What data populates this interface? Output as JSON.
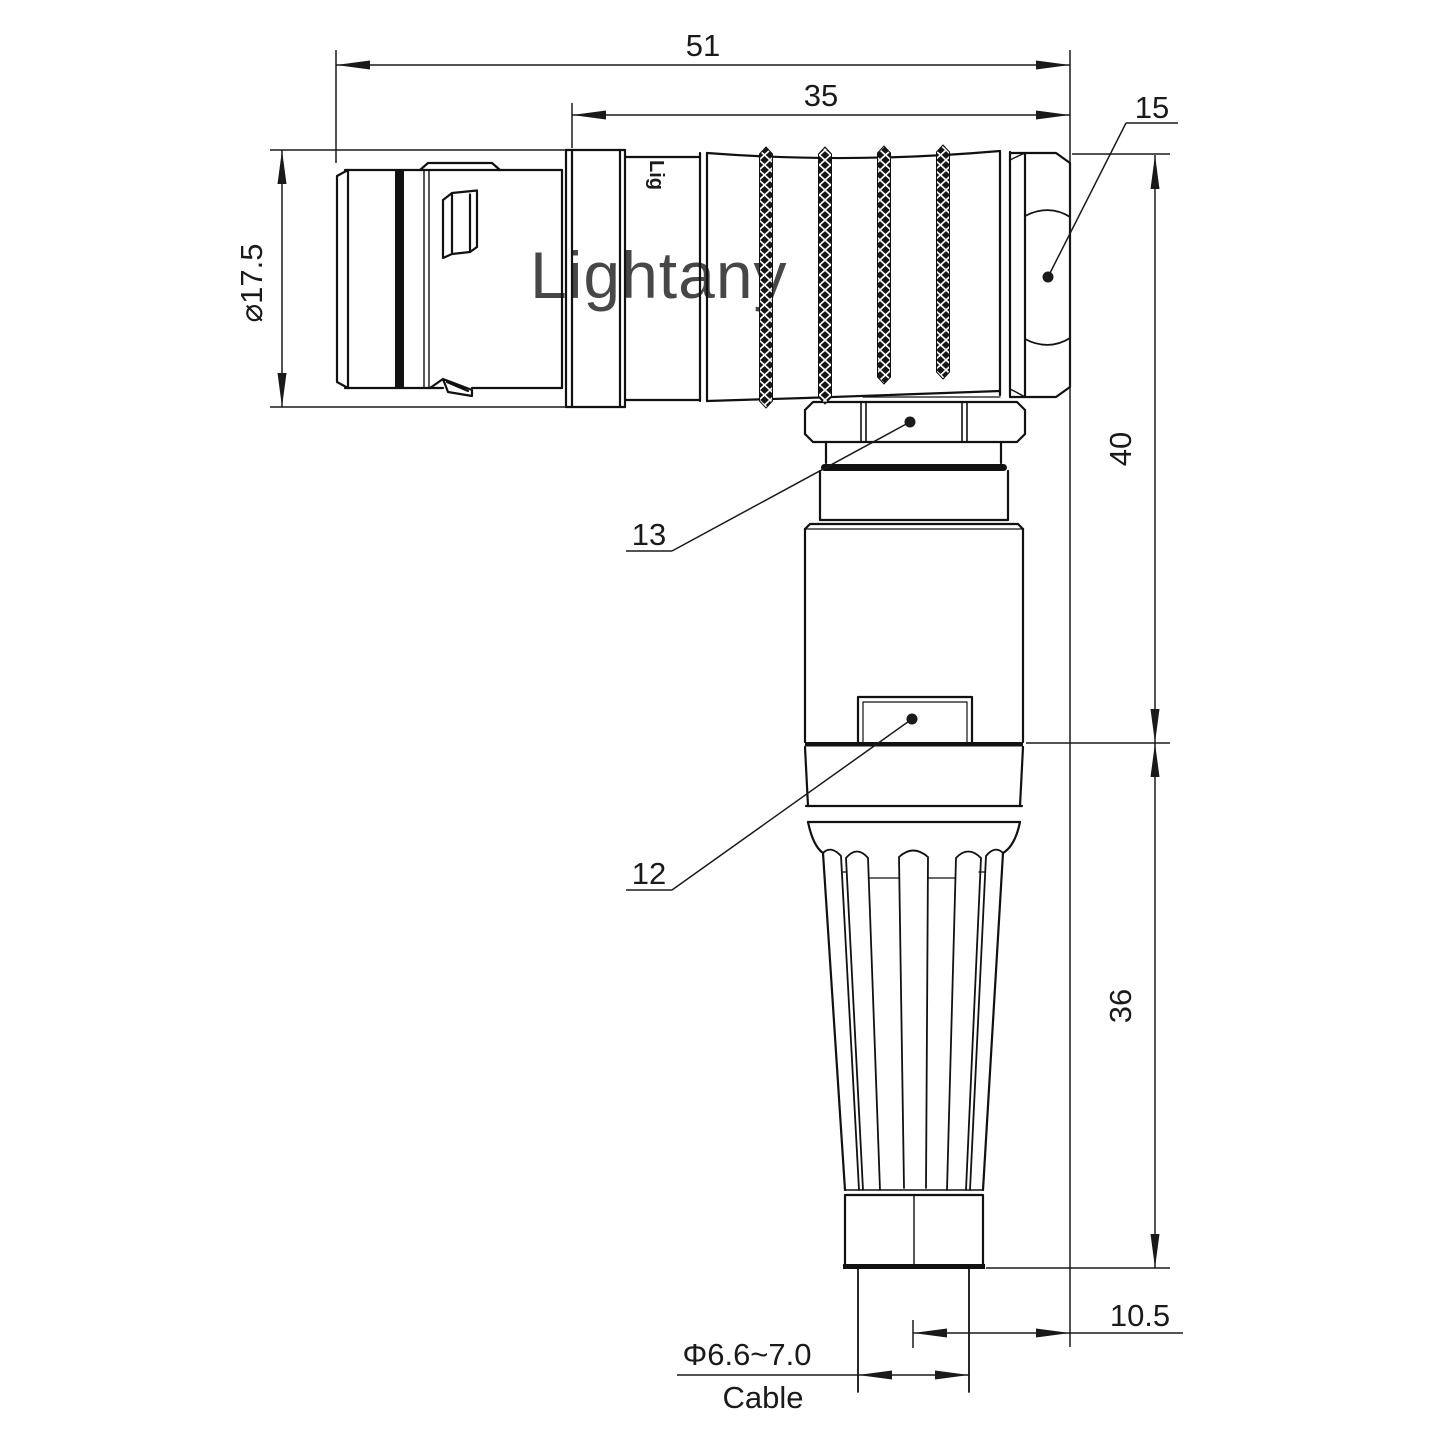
{
  "watermark": {
    "text": "Lightany",
    "color": "#efb6b6"
  },
  "part": {
    "engraving": "Lig"
  },
  "dims": {
    "overall_len": "51",
    "rear_len": "35",
    "hex_ref": "15",
    "front_dia": "⌀17.5",
    "upper_h": "40",
    "nut_ref": "13",
    "latch_ref": "12",
    "lower_h": "36",
    "offset": "10.5",
    "cable_dia": "Φ6.6~7.0",
    "cable_label": "Cable"
  },
  "colors": {
    "line": "#111111",
    "dimline": "#1a1a1a",
    "background": "#ffffff",
    "watermark": "#efb6b6"
  }
}
